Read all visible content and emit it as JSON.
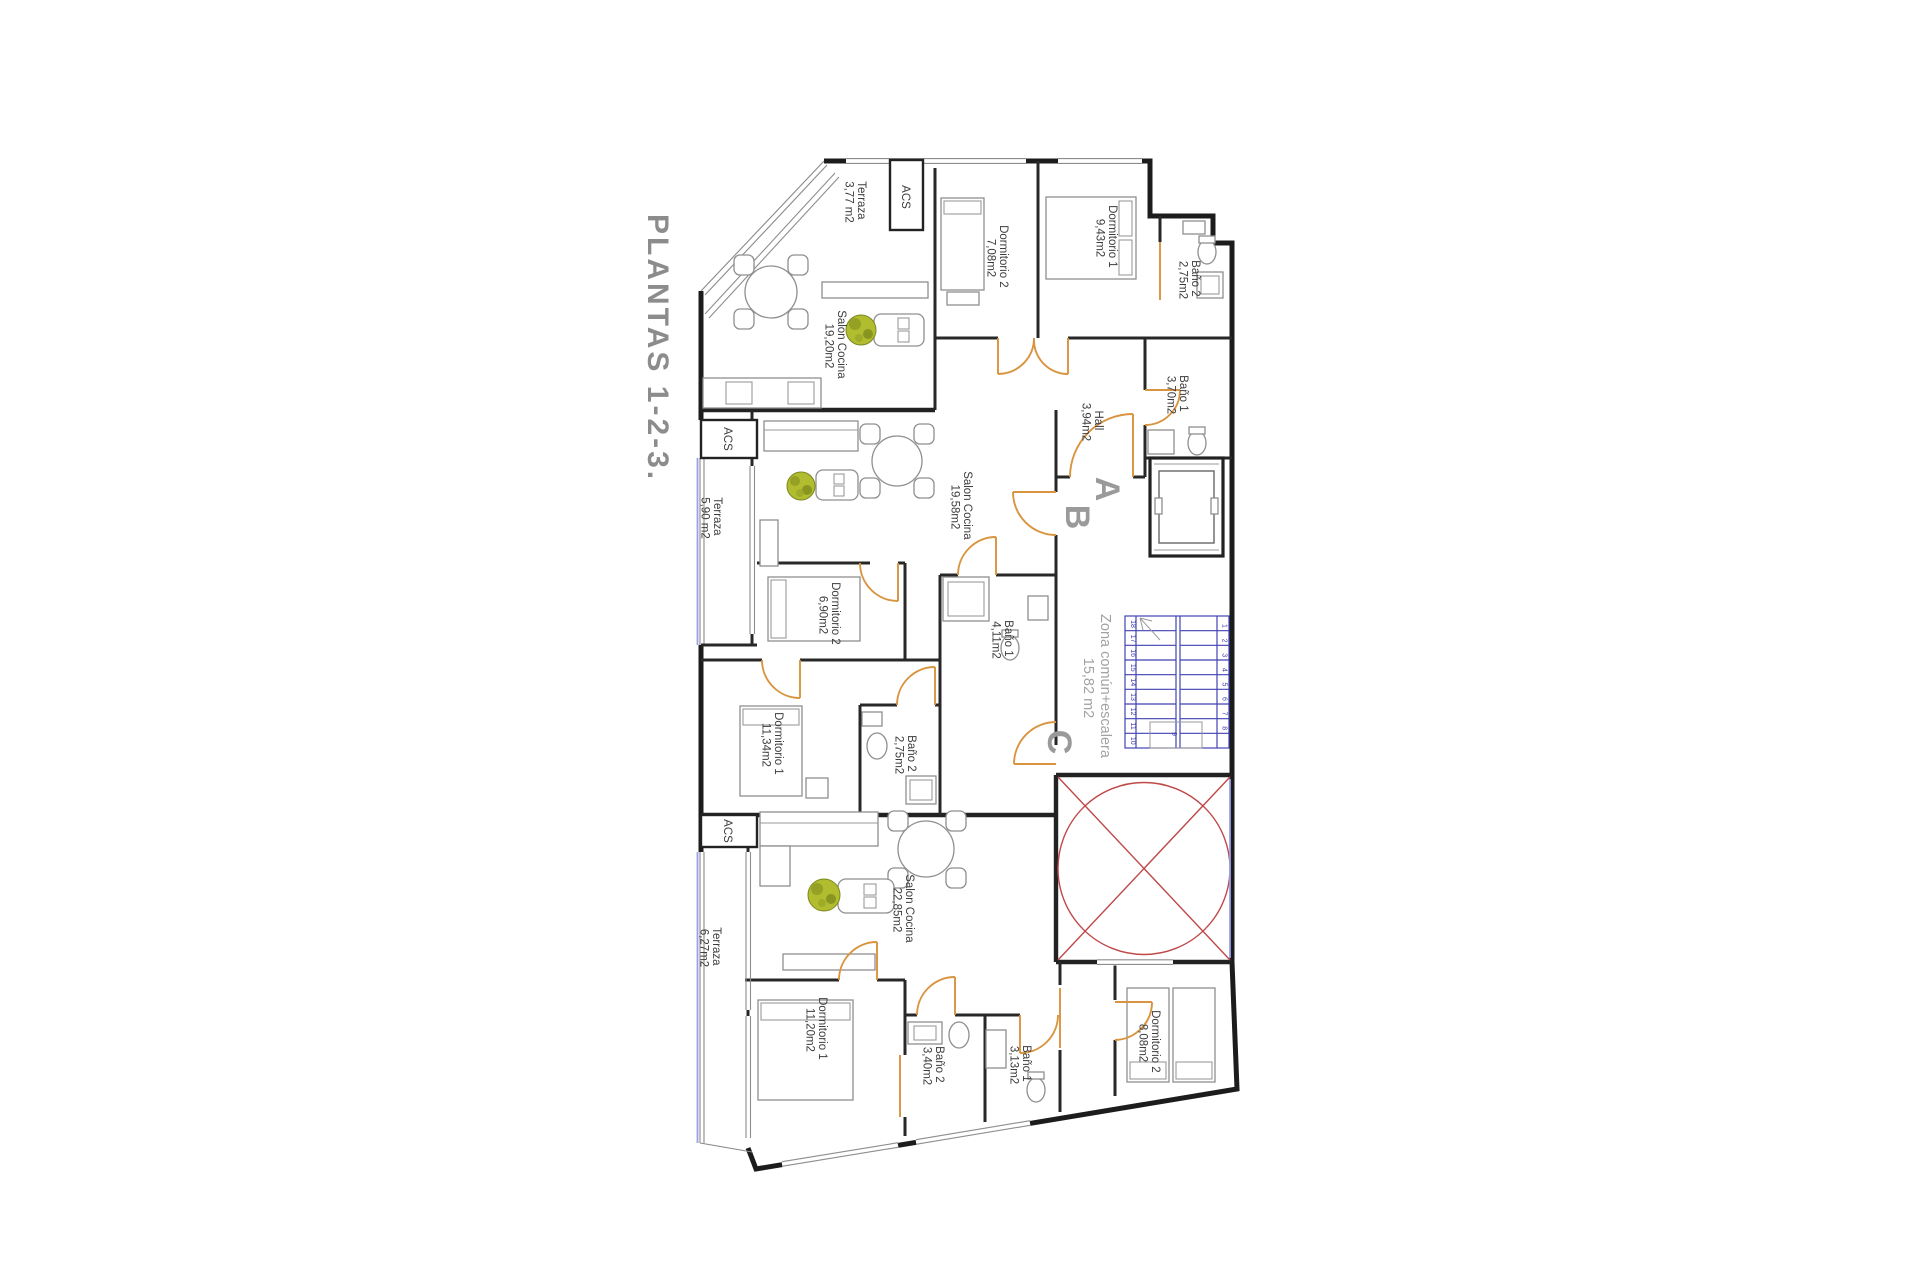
{
  "title": "PLANTAS 1-2-3.",
  "common": {
    "letter_a": "A",
    "letter_b": "B",
    "letter_c": "C",
    "zona_line1": "Zona común+escalera",
    "zona_line2": "15,82 m2"
  },
  "apt_a": {
    "acs": "ACS",
    "terraza": {
      "name": "Terraza",
      "area": "3,77 m2"
    },
    "dormitorio2": {
      "name": "Dormitorio 2",
      "area": "7,08m2"
    },
    "dormitorio1": {
      "name": "Dormitorio 1",
      "area": "9,43m2"
    },
    "bano2": {
      "name": "Baño 2",
      "area": "2,75m2"
    },
    "salon": {
      "name": "Salon Cocina",
      "area": "19,20m2"
    },
    "bano1": {
      "name": "Baño 1",
      "area": "3,70m2"
    },
    "hall": {
      "name": "Hall",
      "area": "3,94m2"
    }
  },
  "apt_b": {
    "acs": "ACS",
    "terraza": {
      "name": "Terraza",
      "area": "5,90 m2"
    },
    "salon": {
      "name": "Salon Cocina",
      "area": "19,58m2"
    },
    "dormitorio2": {
      "name": "Dormitorio 2",
      "area": "6,90m2"
    },
    "bano1": {
      "name": "Baño 1",
      "area": "4,11m2"
    },
    "dormitorio1": {
      "name": "Dormitorio 1",
      "area": "11,34m2"
    },
    "bano2": {
      "name": "Baño 2",
      "area": "2,75m2"
    }
  },
  "apt_c": {
    "acs": "ACS",
    "terraza": {
      "name": "Terraza",
      "area": "6,27m2"
    },
    "salon": {
      "name": "Salon Cocina",
      "area": "22,85m2"
    },
    "dormitorio1": {
      "name": "Dormitorio 1",
      "area": "11,20m2"
    },
    "bano2": {
      "name": "Baño 2",
      "area": "3,40m2"
    },
    "bano1": {
      "name": "Baño 1",
      "area": "3,13m2"
    },
    "dormitorio2": {
      "name": "Dormitorio 2",
      "area": "8,08m2"
    }
  },
  "stairs": {
    "numbers_left": [
      "18",
      "17",
      "16",
      "15",
      "14",
      "13",
      "12",
      "11",
      "10"
    ],
    "numbers_right": [
      "1",
      "2",
      "3",
      "4",
      "5",
      "6",
      "7",
      "8"
    ],
    "number_mid": "9"
  },
  "colors": {
    "door": "#d8943e",
    "stairs": "#4242b4",
    "courtyard": "#c04848",
    "terrace_edge": "#98a0e8",
    "plant": "#b1bd2e",
    "title_gray": "#8c8c8c"
  }
}
